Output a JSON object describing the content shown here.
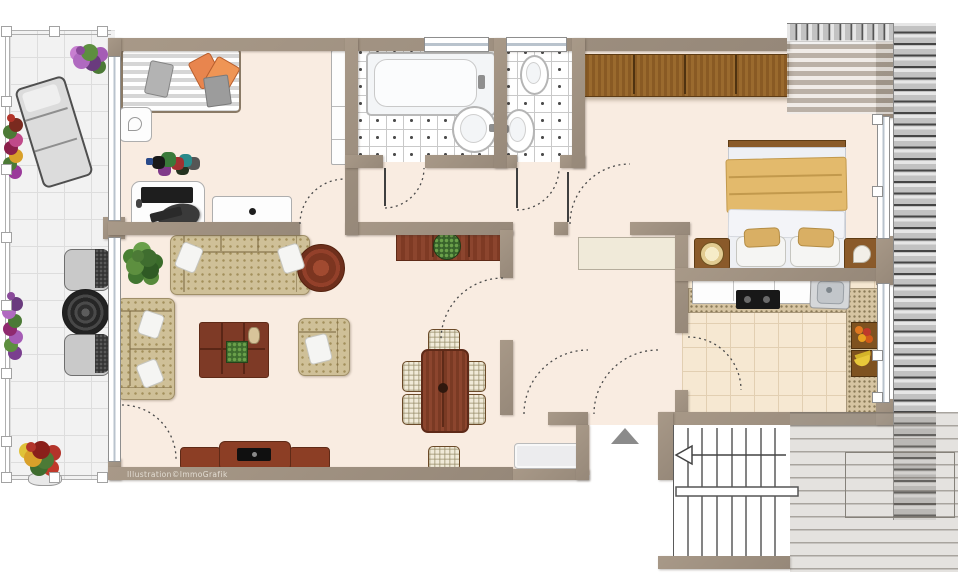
{
  "watermark": {
    "text": "Illustration©ImmoGrafik"
  },
  "colors": {
    "wall": "#9a8c7d",
    "apartment_floor": "#f9ece1",
    "terrace_tile": "#f2f2f2",
    "bath_tile_line": "#c9c9c9",
    "kitchen_tile": "#f6e8d2",
    "wood_dark_red": "#8c3e25",
    "wood_brown": "#8d5c26",
    "sofa_beige": "#cfc098",
    "bed_blanket_yellow": "#e3ba6c",
    "pillow_orange": "#e8854e",
    "deck_gray": "#c6c6c6",
    "window_glass": "#b9c3cd",
    "arrow_gray": "#8b8b8b"
  },
  "floorplan": {
    "type": "apartment-floor-plan-top-view",
    "rooms": [
      {
        "id": "terrace",
        "items": [
          "flower-pot-top",
          "flower-box-upper",
          "sun-lounger",
          "flower-box-lower",
          "wicker-chair-1",
          "wicker-side-table",
          "wicker-chair-2",
          "flower-pot-bottom",
          "railing-posts",
          "tiled-floor"
        ]
      },
      {
        "id": "office-guest-room",
        "items": [
          "guest-bed",
          "nightstand",
          "wall-cabinet",
          "desk",
          "monitor",
          "keyboard",
          "desk-chair",
          "dresser",
          "shelf-clutter"
        ]
      },
      {
        "id": "bathroom",
        "items": [
          "bathtub",
          "wash-basin",
          "window",
          "tiled-floor"
        ]
      },
      {
        "id": "wc",
        "items": [
          "toilet",
          "wash-basin",
          "window",
          "tiled-floor"
        ]
      },
      {
        "id": "hallway",
        "items": [
          "shelf",
          "doormat",
          "entrance-double-door",
          "entrance-arrow"
        ]
      },
      {
        "id": "living-dining-room",
        "items": [
          "sofa-3-seat",
          "sofa-2-seat",
          "armchair",
          "coffee-table",
          "round-side-table",
          "plant",
          "dining-table",
          "dining-chairs-6",
          "tv-lowboard",
          "sideboard-with-plant",
          "balcony-door"
        ]
      },
      {
        "id": "bedroom",
        "items": [
          "wardrobe",
          "double-bed",
          "nightstand-with-clock",
          "nightstand-with-shell",
          "roof-slope-shading",
          "windows"
        ]
      },
      {
        "id": "kitchen",
        "items": [
          "upper-cabinets",
          "cooktop",
          "sink-unit",
          "granite-counter",
          "fruit-basket-1",
          "fruit-basket-2",
          "tiled-floor"
        ]
      },
      {
        "id": "stairwell",
        "items": [
          "staircase",
          "direction-arrow",
          "landing"
        ]
      }
    ],
    "stairs_arrow_direction": "left",
    "entrance_marker": "triangle-up"
  }
}
